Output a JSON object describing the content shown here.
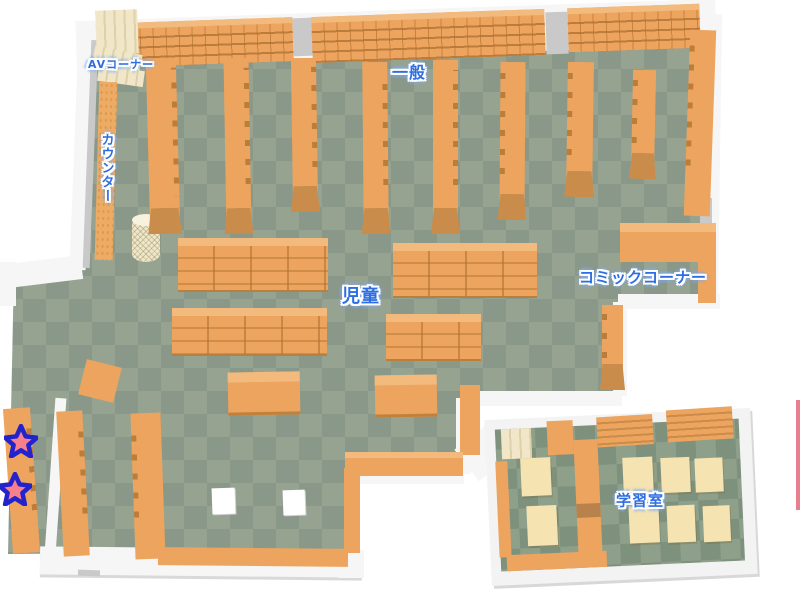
{
  "areas": {
    "av_corner": {
      "label": "AVコーナー"
    },
    "counter": {
      "label": "カウンター"
    },
    "general": {
      "label": "一般"
    },
    "children": {
      "label": "児童"
    },
    "comic_corner": {
      "label": "コミックコーナー"
    },
    "study_room": {
      "label": "学習室"
    }
  },
  "markers": [
    {
      "id": "star-1",
      "shape": "star",
      "fill": "#f8808c",
      "outline": "#2323cd"
    },
    {
      "id": "star-2",
      "shape": "star",
      "fill": "#f8808c",
      "outline": "#2323cd"
    }
  ],
  "colors": {
    "floor_light": "#97a391",
    "floor_dark": "#8a988a",
    "shelf": "#eda45e",
    "shelf_dark": "#c98c4b",
    "shelf_top": "#f2ba7d",
    "wall": "#f6f6f6",
    "av_shelf": "#f1e7c8",
    "desk": "#f5e3b1",
    "label_blue": "#2e6ee2",
    "edge_accent": "#e87f8f"
  }
}
